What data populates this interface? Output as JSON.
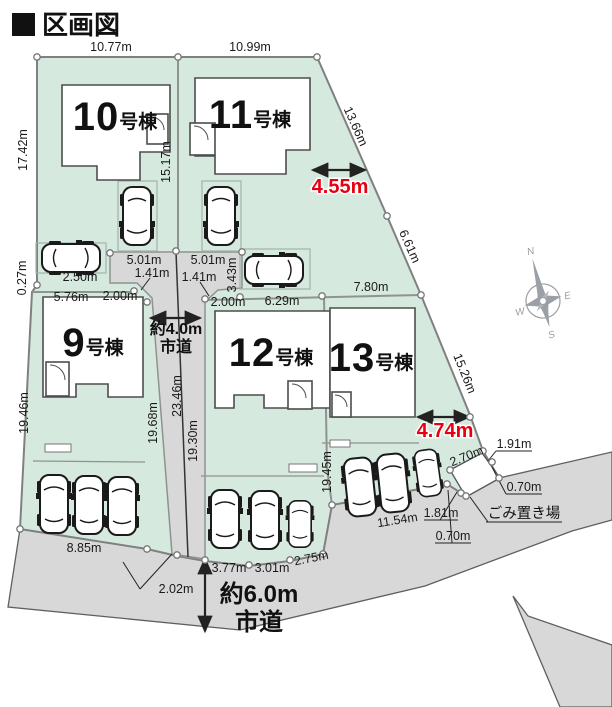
{
  "title": "区画図",
  "colors": {
    "lot_green": "#d5e9de",
    "road_gray": "#d8d8d8",
    "boundary_gray": "#8f938f",
    "accent_red": "#e60012"
  },
  "lots": {
    "b9": {
      "no": "9",
      "suffix": "号棟"
    },
    "b10": {
      "no": "10",
      "suffix": "号棟"
    },
    "b11": {
      "no": "11",
      "suffix": "号棟"
    },
    "b12": {
      "no": "12",
      "suffix": "号棟"
    },
    "b13": {
      "no": "13",
      "suffix": "号棟"
    }
  },
  "dims": {
    "w10_top": "10.77m",
    "w11_top": "10.99m",
    "l10_left": "17.42m",
    "l10_11": "15.17m",
    "diag_ne": "13.66m",
    "red_east_upper": "4.55m",
    "diag_e": "6.61m",
    "w13_top": "7.80m",
    "jog_left": "0.27m",
    "park_w": "2.50m",
    "l9_top": "5.76m",
    "l9_top2": "2.00m",
    "ham_left": "5.01m",
    "ham_left_diag": "1.41m",
    "ham_right": "5.01m",
    "ham_right_diag": "1.41m",
    "park11_h": "3.43m",
    "l12_top1": "2.00m",
    "l12_top2": "6.29m",
    "road4_center": "23.46m",
    "l9_right": "19.68m",
    "l12_left": "19.30m",
    "l9_left": "19.46m",
    "l12_13": "19.45m",
    "diag_se": "15.26m",
    "red_east_lower": "4.74m",
    "gq_top": "2.70m",
    "gq_r1": "1.91m",
    "gq_r2": "0.70m",
    "l13_bottom": "11.54m",
    "gq_l1": "1.81m",
    "gq_l2": "0.70m",
    "l9_bottom": "8.85m",
    "road_mouth": "2.02m",
    "l12_b1": "3.77m",
    "l12_b2": "3.01m",
    "l12_b3": "2.75m"
  },
  "roads": {
    "road4_line1": "約4.0m",
    "road4_line2": "市道",
    "road6_line1": "約6.0m",
    "road6_line2": "市道"
  },
  "garbage_label": "ごみ置き場",
  "compass": {
    "n": "N",
    "e": "E",
    "s": "S",
    "w": "W"
  }
}
